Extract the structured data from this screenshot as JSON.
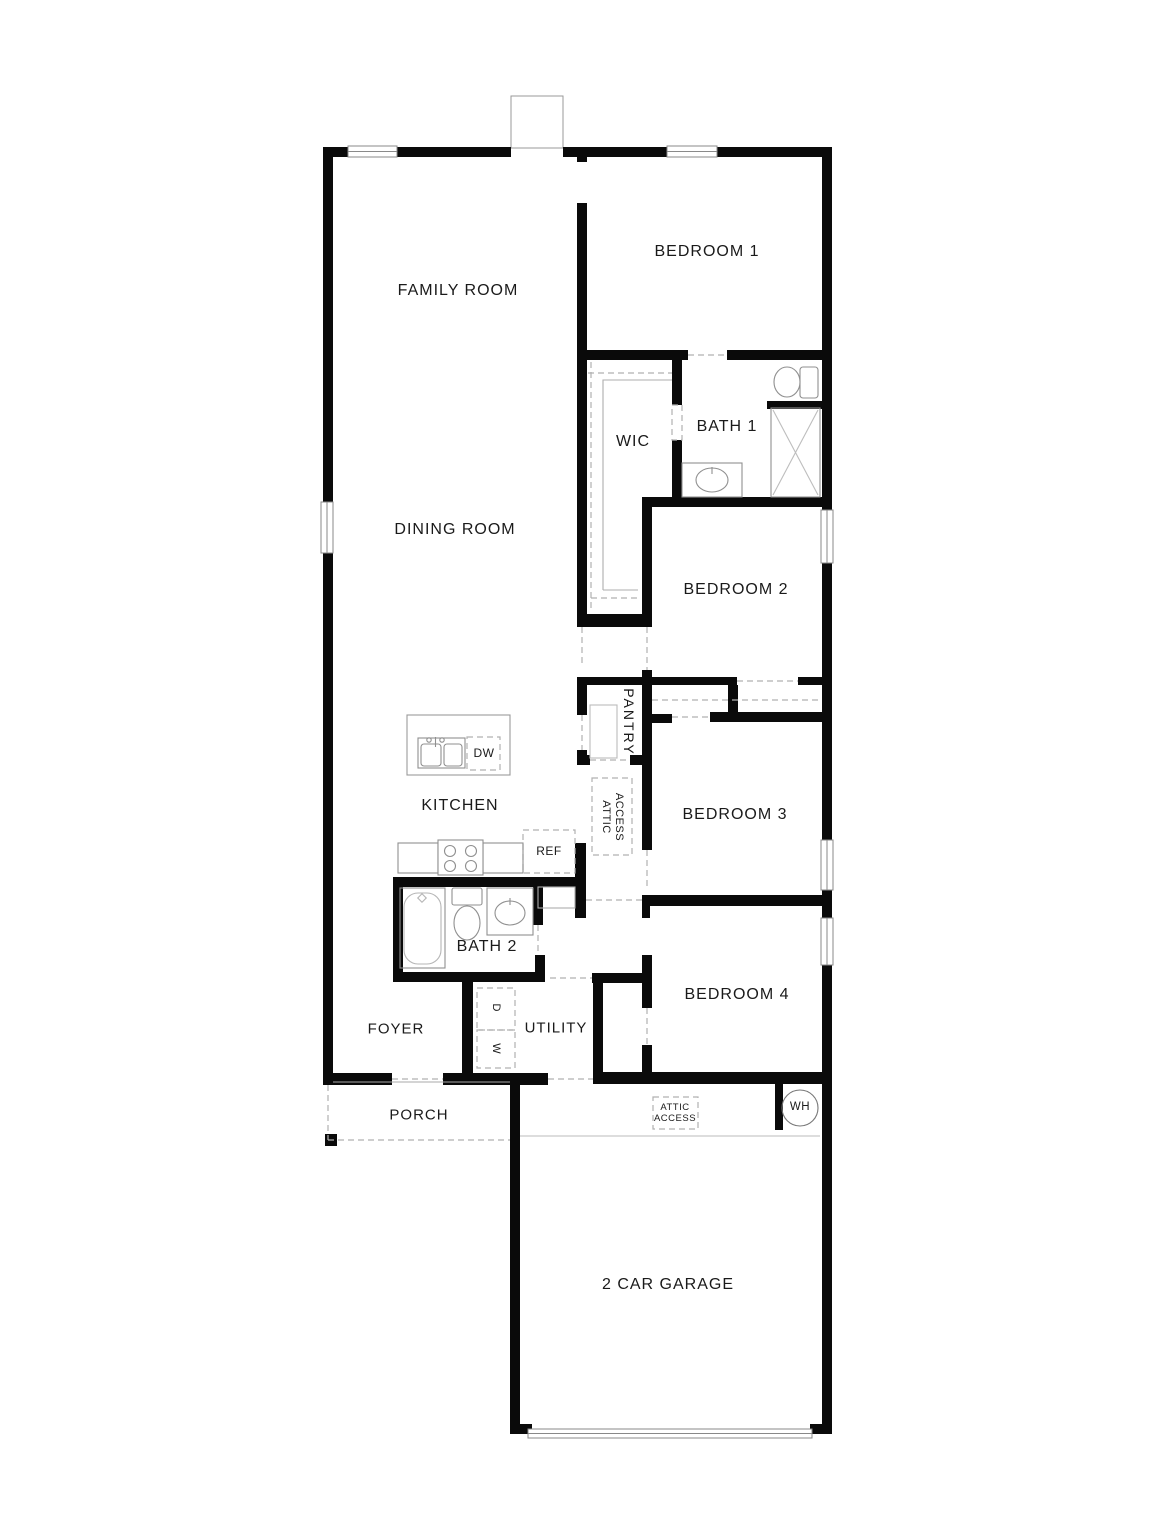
{
  "title": "Floor plan",
  "rooms": {
    "family_room": "FAMILY ROOM",
    "bedroom1": "BEDROOM 1",
    "wic": "WIC",
    "bath1": "BATH 1",
    "dining_room": "DINING ROOM",
    "bedroom2": "BEDROOM 2",
    "pantry": "PANTRY",
    "kitchen": "KITCHEN",
    "bedroom3": "BEDROOM 3",
    "bath2": "BATH 2",
    "bedroom4": "BEDROOM 4",
    "foyer": "FOYER",
    "utility": "UTILITY",
    "porch": "PORCH",
    "garage": "2 CAR GARAGE"
  },
  "fixtures": {
    "dishwasher": "DW",
    "refrigerator": "REF",
    "dryer": "D",
    "washer": "W",
    "water_heater": "WH",
    "attic_line1": "ATTIC",
    "attic_line2": "ACCESS"
  },
  "colors": {
    "wall": "#0a0a0a",
    "thin_line": "#999999",
    "dashed_line": "#b0b0b0",
    "text": "#1a1a1a",
    "background": "#ffffff"
  }
}
